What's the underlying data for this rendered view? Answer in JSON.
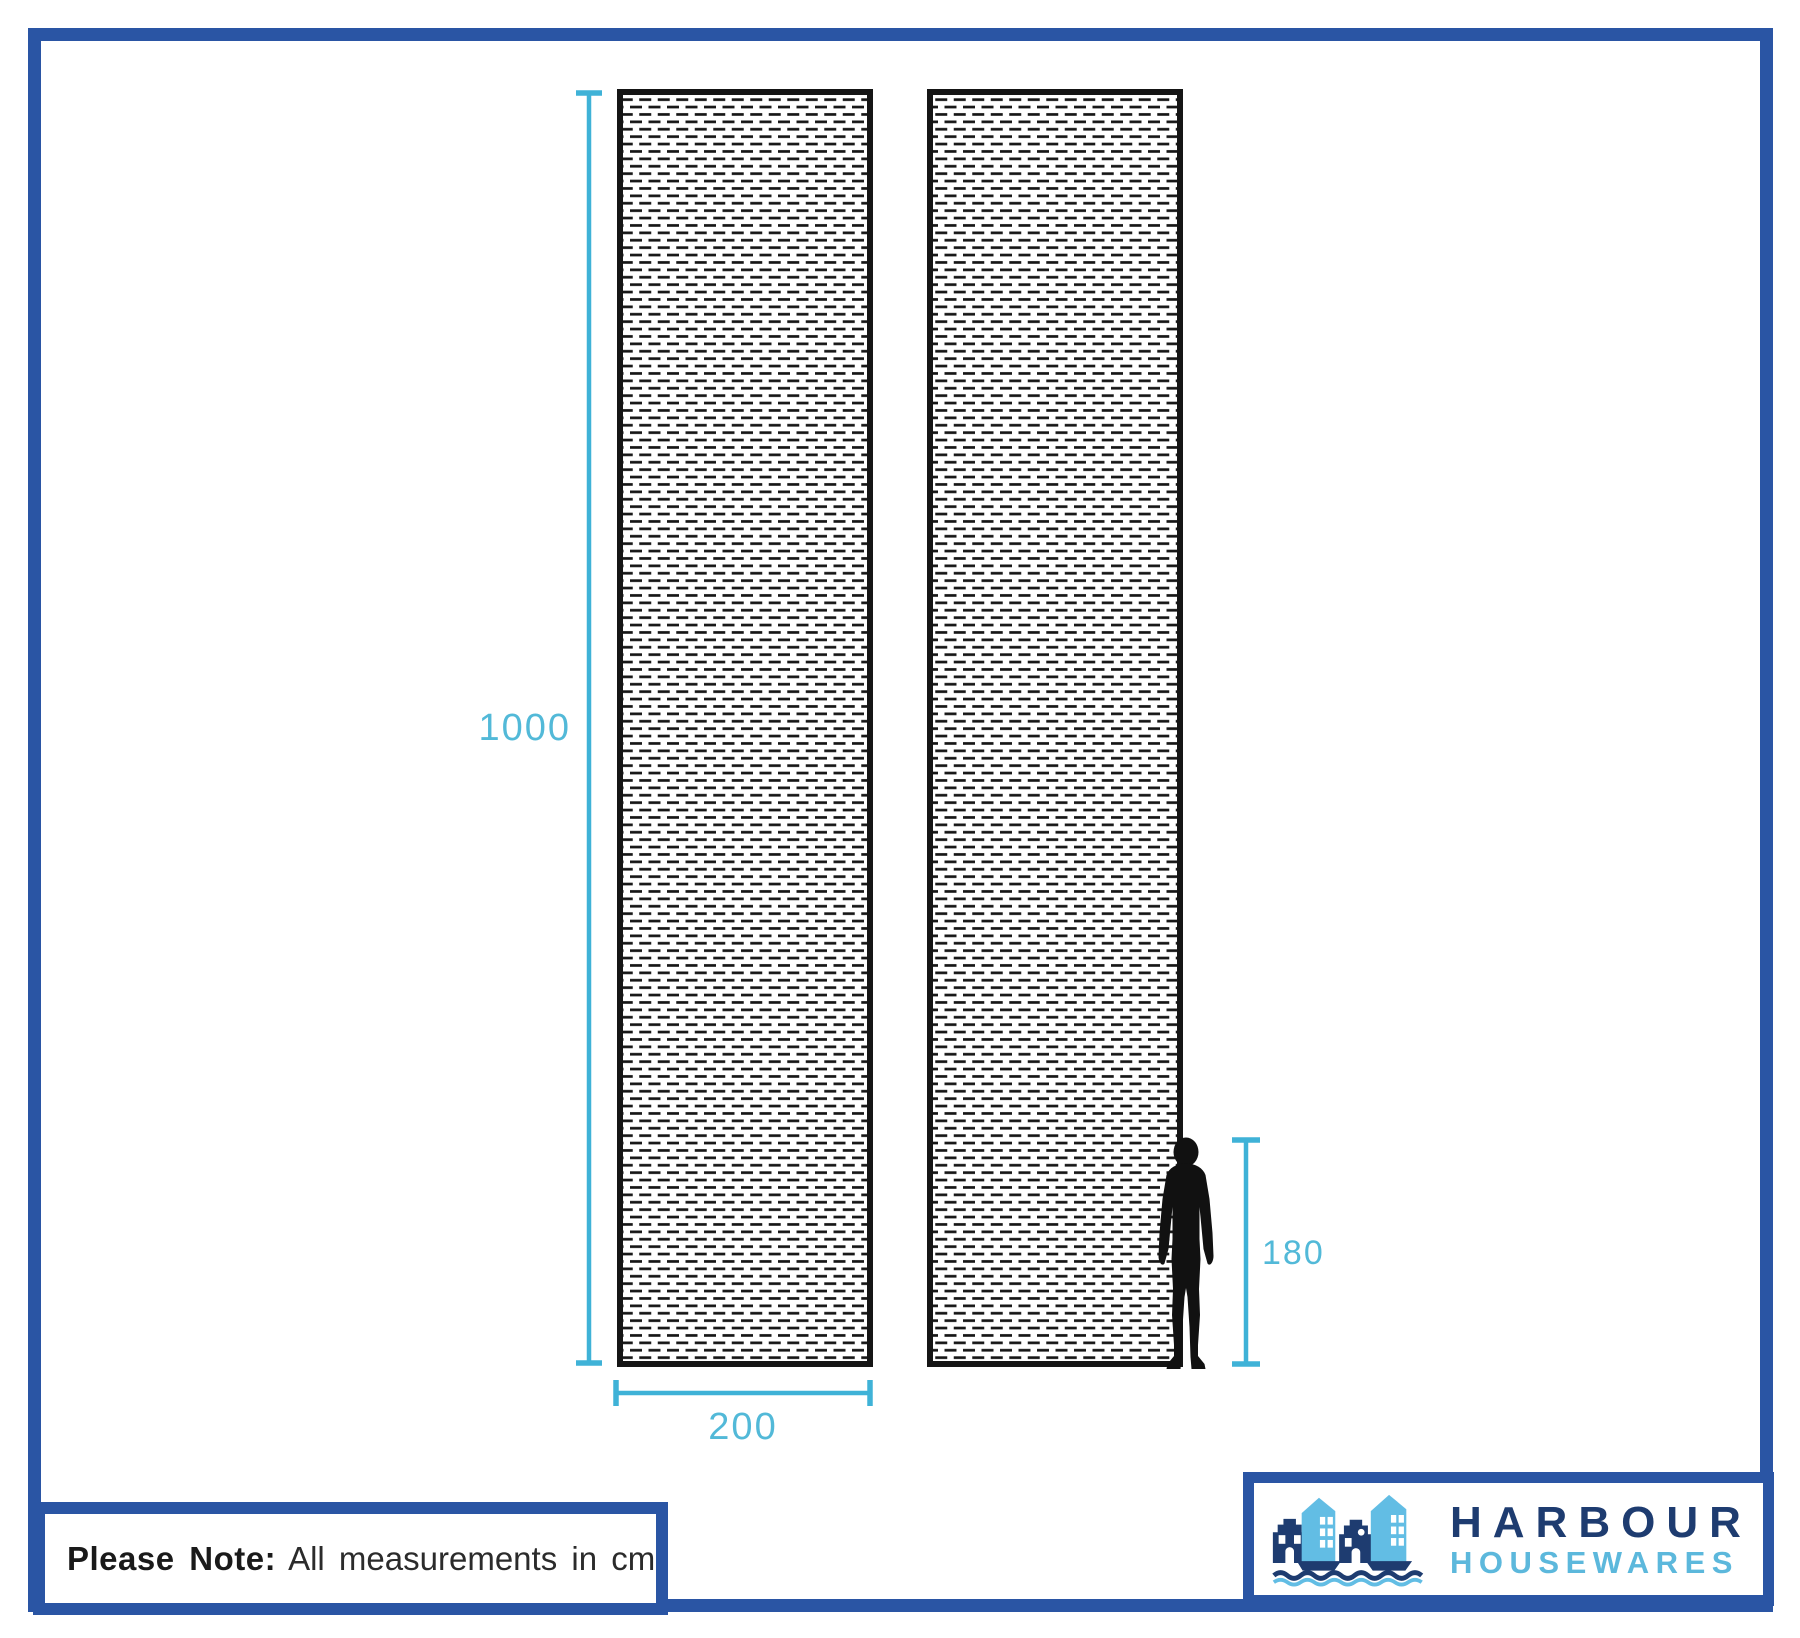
{
  "diagram": {
    "unit_note": {
      "prefix": "Please Note:",
      "text": "All measurements in cm"
    },
    "measurements": {
      "panel_height": "1000",
      "panel_width": "200",
      "person_height": "180"
    },
    "panels": {
      "count": 2,
      "pattern": "mesh-netting"
    }
  },
  "logo": {
    "name_top": "HARBOUR",
    "name_bottom": "HOUSEWARES",
    "mark": "harbour-houses-sailboats-icon"
  },
  "icons": {
    "person": "human-silhouette-icon"
  },
  "colors": {
    "frame_blue": "#2a55a4",
    "dimension_line_blue": "#3fb2d7",
    "dimension_text_blue": "#52b9d8",
    "panel_outline_black": "#151515",
    "mesh_dash_black": "#161616",
    "silhouette_black": "#111111",
    "logo_navy": "#1e3c70",
    "logo_light_blue": "#5cb8dc"
  }
}
